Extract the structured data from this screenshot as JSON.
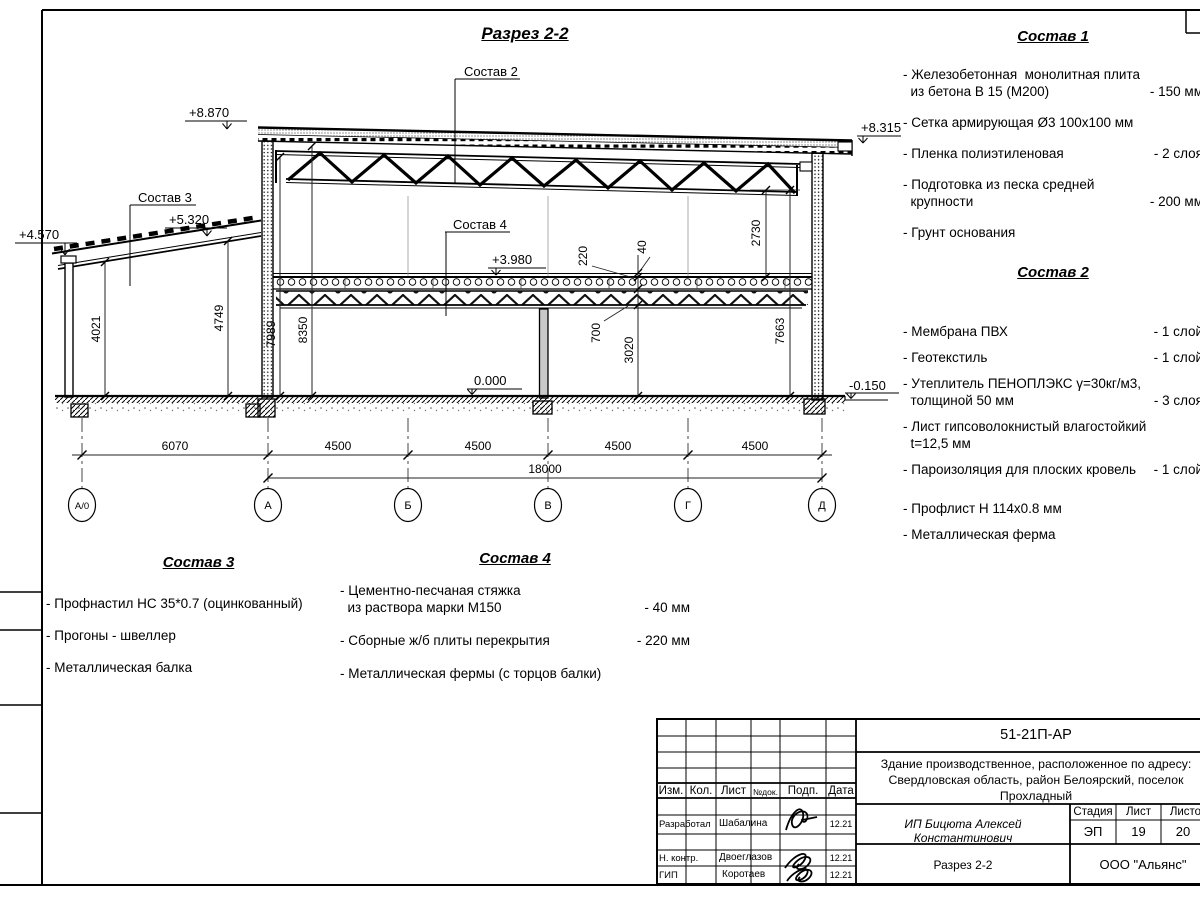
{
  "sheet": {
    "drawing_title": "Разрез 2-2"
  },
  "drawing": {
    "labels": {
      "sostav2": "Состав 2",
      "sostav3": "Состав 3",
      "sostav4": "Состав 4"
    },
    "levels": {
      "roof_left": "+8.870",
      "roof_right": "+8.315",
      "annex_eave": "+4.570",
      "annex_top": "+5.320",
      "floor2": "+3.980",
      "floor1": "0.000",
      "ground": "-0.150"
    },
    "dims": {
      "annex_left": "4021",
      "annex_right": "4749",
      "col_a_inner": "7989",
      "col_a_outer": "8350",
      "slab": "220",
      "screed": "40",
      "truss_floor": "700",
      "clear_first": "3020",
      "clear_second": "2730",
      "wall_right": "7663"
    },
    "bottom_dims": [
      "6070",
      "4500",
      "4500",
      "4500",
      "4500"
    ],
    "total_dim": "18000",
    "axes": [
      "А/0",
      "А",
      "Б",
      "В",
      "Г",
      "Д"
    ]
  },
  "compositions": [
    {
      "title": "Состав 1",
      "items": [
        {
          "text": "- Железобетонная  монолитная плита\n  из бетона В 15 (М200)",
          "value": "- 150 мм"
        },
        {
          "text": "- Сетка армирующая Ø3 100х100 мм",
          "value": ""
        },
        {
          "text": "- Пленка полиэтиленовая",
          "value": "- 2 слоя"
        },
        {
          "text": "- Подготовка из песка средней\n  крупности",
          "value": "- 200 мм"
        },
        {
          "text": "- Грунт основания",
          "value": ""
        }
      ]
    },
    {
      "title": "Состав 2",
      "items": [
        {
          "text": "- Мембрана ПВХ",
          "value": "- 1 слой"
        },
        {
          "text": "- Геотекстиль",
          "value": "- 1 слой"
        },
        {
          "text": "- Утеплитель ПЕНОПЛЭКС γ=30кг/м3,\n  толщиной 50 мм",
          "value": "- 3 слоя"
        },
        {
          "text": "- Лист гипсоволокнистый влагостойкий\n  t=12,5 мм",
          "value": ""
        },
        {
          "text": "- Пароизоляция для плоских кровель",
          "value": "- 1 слой"
        },
        {
          "text": "- Профлист Н 114х0.8 мм",
          "value": ""
        },
        {
          "text": "- Металлическая ферма",
          "value": ""
        }
      ]
    },
    {
      "title": "Состав 3",
      "items": [
        {
          "text": "- Профнастил НС 35*0.7 (оцинкованный)",
          "value": ""
        },
        {
          "text": "- Прогоны - швеллер",
          "value": ""
        },
        {
          "text": "- Металлическая балка",
          "value": ""
        }
      ]
    },
    {
      "title": "Состав 4",
      "items": [
        {
          "text": "- Цементно-песчаная стяжка\n  из раствора марки М150",
          "value": "- 40 мм"
        },
        {
          "text": "- Сборные ж/б плиты перекрытия",
          "value": "- 220 мм"
        },
        {
          "text": "- Металлическая фермы (с торцов балки)",
          "value": ""
        }
      ]
    }
  ],
  "titleblock": {
    "doc_number": "51-21П-АР",
    "object_description": "Здание производственное, расположенное по адресу:\nСвердловская область, район Белоярский, поселок\nПрохладный",
    "columns": {
      "izm": "Изм.",
      "kol": "Кол.",
      "list": "Лист",
      "ndok": "№док.",
      "podp": "Подп.",
      "data": "Дата"
    },
    "rows": [
      {
        "role": "Разработал",
        "name": "Шабалина",
        "date": "12.21"
      },
      {
        "role": "Н. контр.",
        "name": "Двоеглазов",
        "date": "12.21"
      },
      {
        "role": "ГИП",
        "name": "Коротаев",
        "date": "12.21"
      }
    ],
    "customer": "ИП Бицюта Алексей Константинович",
    "stage_label": "Стадия",
    "sheet_label": "Лист",
    "sheets_label": "Листов",
    "stage": "ЭП",
    "sheet_no": "19",
    "sheets_total": "20",
    "sheet_title": "Разрез 2-2",
    "company": "ООО \"Альянс\""
  }
}
